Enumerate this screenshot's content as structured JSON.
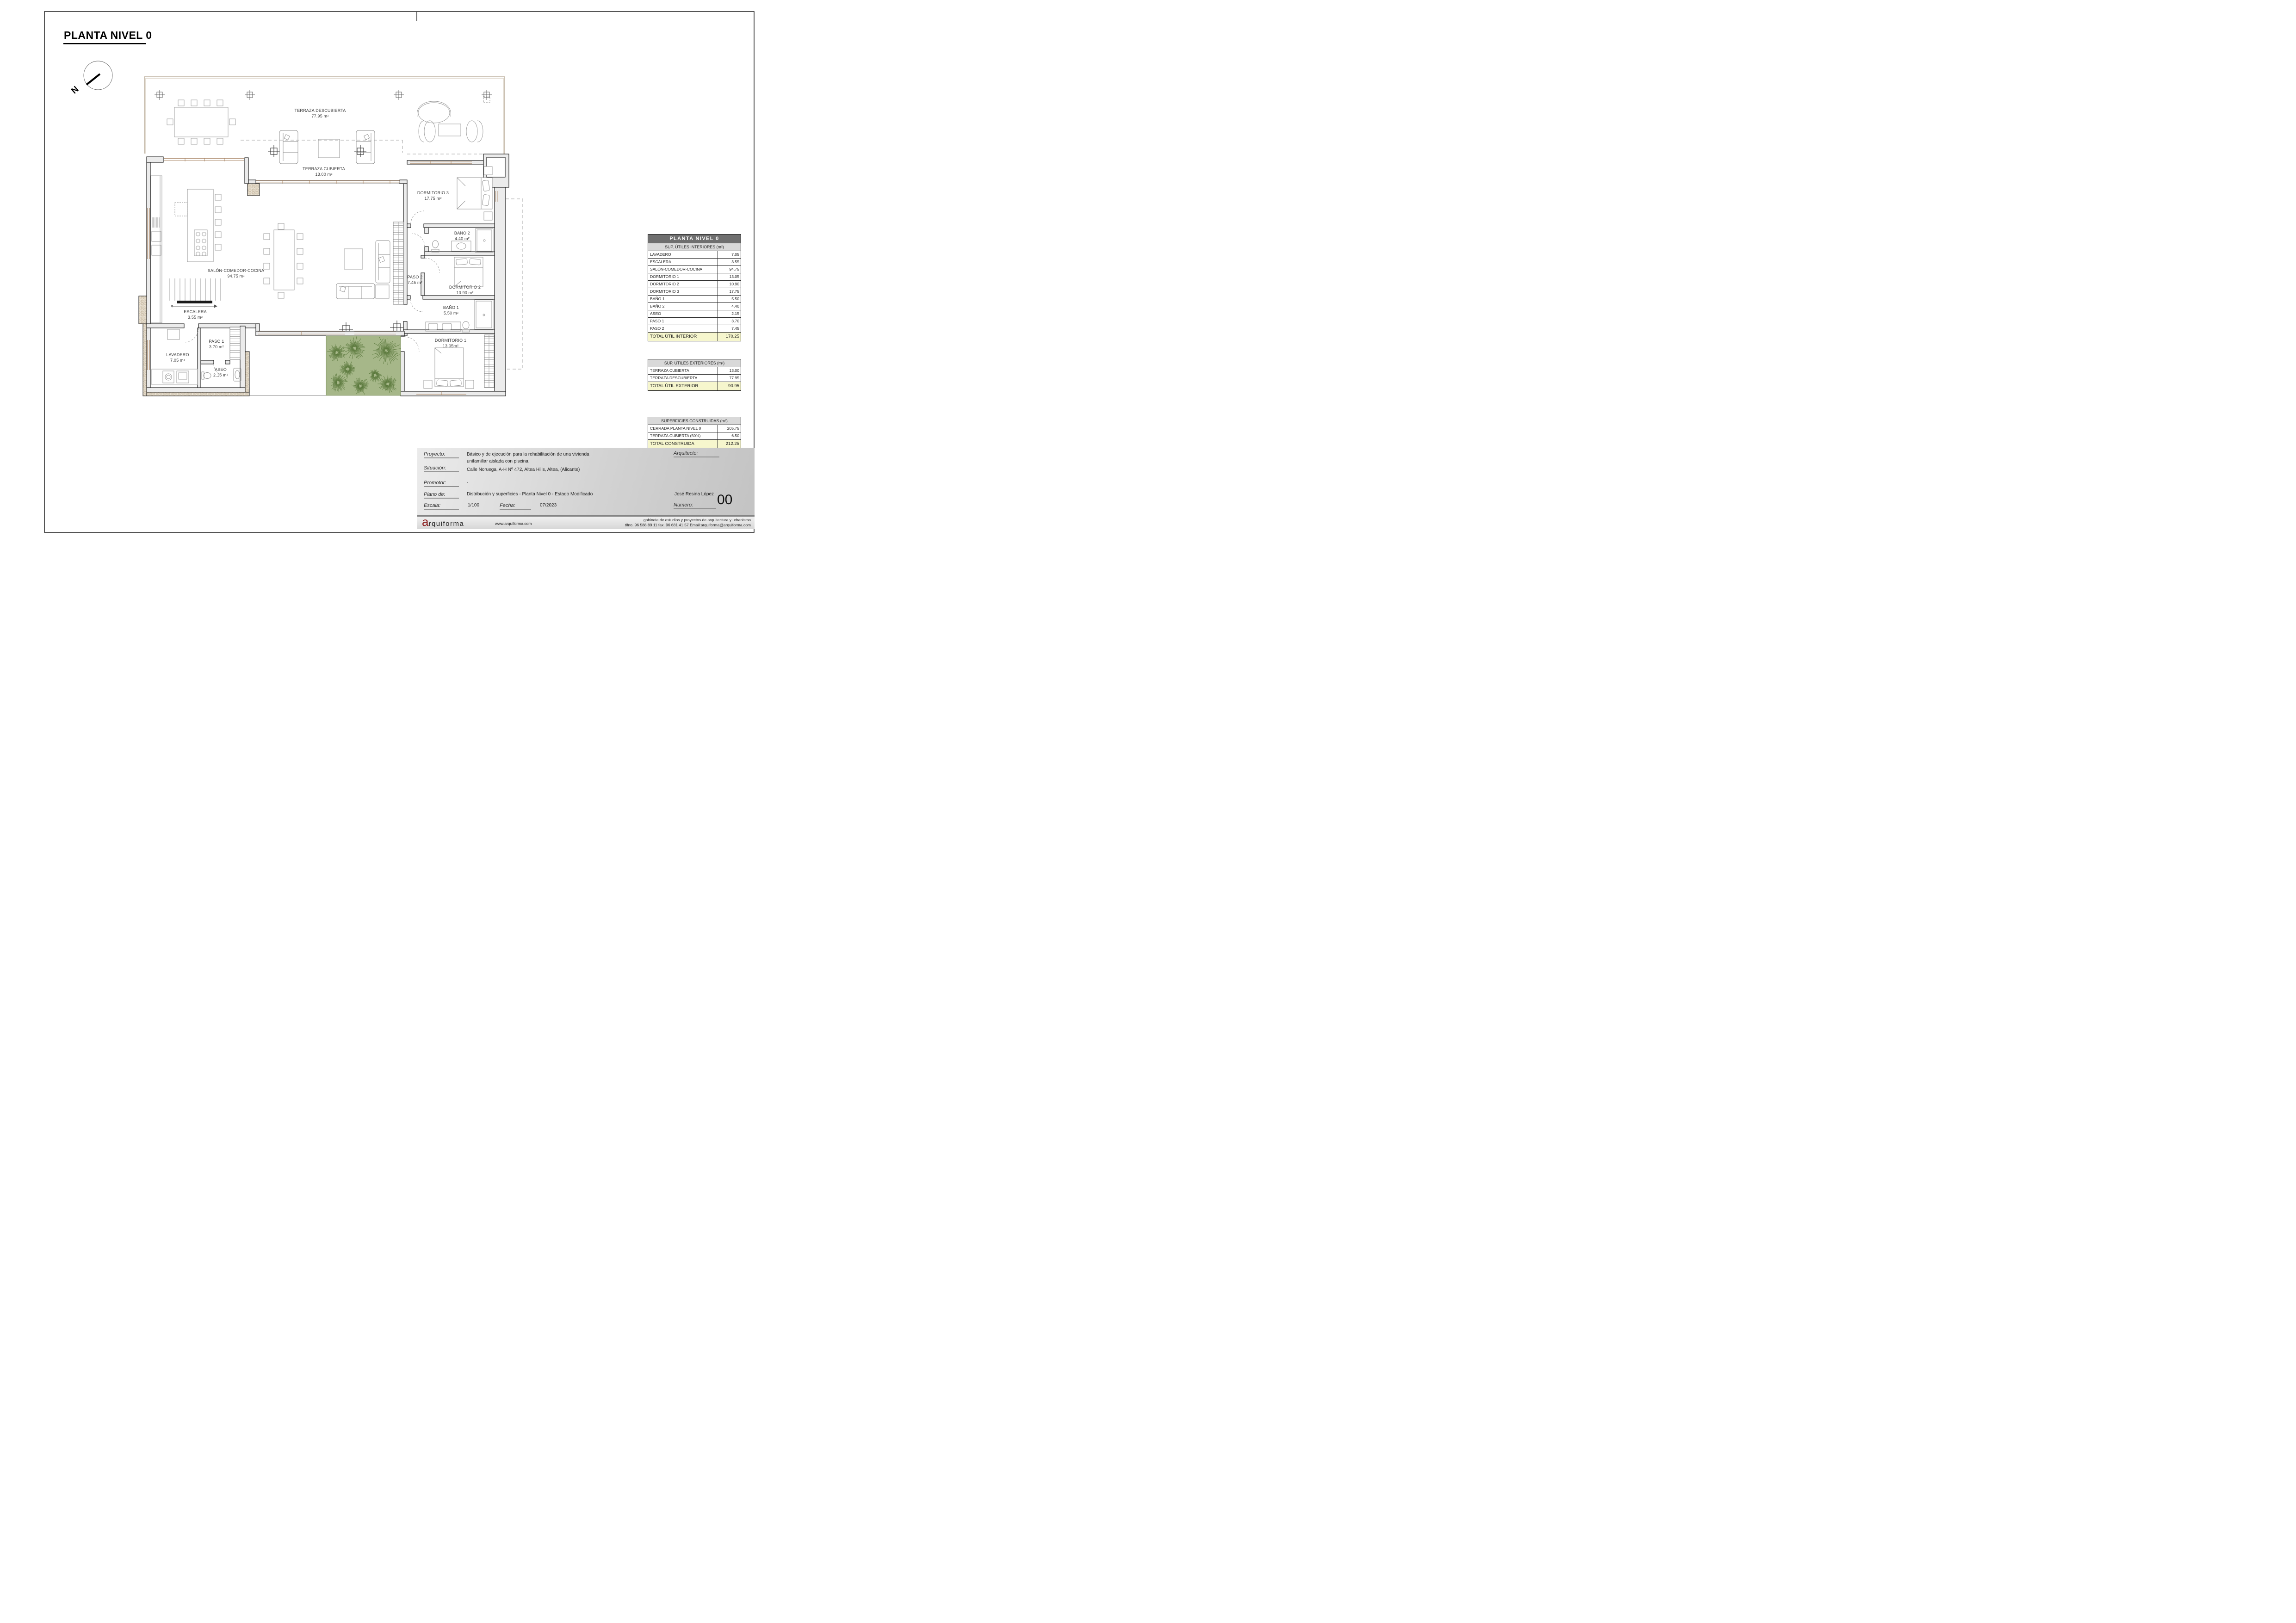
{
  "sheet": {
    "title": "PLANTA NIVEL 0",
    "north_label": "N"
  },
  "plan": {
    "rooms": [
      {
        "name": "TERRAZA DESCUBIERTA",
        "area": "77.95 m²"
      },
      {
        "name": "TERRAZA CUBIERTA",
        "area": "13.00 m²"
      },
      {
        "name": "SALÓN-COMEDOR-COCINA",
        "area": "94.75 m²"
      },
      {
        "name": "DORMITORIO 3",
        "area": "17.75 m²"
      },
      {
        "name": "BAÑO 2",
        "area": "4.40 m²"
      },
      {
        "name": "PASO 2",
        "area": "7.45 m²"
      },
      {
        "name": "DORMITORIO 2",
        "area": "10.90 m²"
      },
      {
        "name": "BAÑO 1",
        "area": "5.50 m²"
      },
      {
        "name": "DORMITORIO 1",
        "area": "13.05m²"
      },
      {
        "name": "ESCALERA",
        "area": "3.55 m²"
      },
      {
        "name": "PASO 1",
        "area": "3.70 m²"
      },
      {
        "name": "LAVADERO",
        "area": "7.05 m²"
      },
      {
        "name": "ASEO",
        "area": "2.15 m²"
      }
    ]
  },
  "tables": {
    "interior": {
      "header": "PLANTA NIVEL 0",
      "subheader": "SUP. ÚTILES INTERIORES (m²)",
      "rows": [
        {
          "label": "LAVADERO",
          "value": "7.05"
        },
        {
          "label": "ESCALERA",
          "value": "3.55"
        },
        {
          "label": "SALÓN-COMEDOR-COCINA",
          "value": "94.75"
        },
        {
          "label": "DORMITORIO 1",
          "value": "13.05"
        },
        {
          "label": "DORMITORIO 2",
          "value": "10.90"
        },
        {
          "label": "DORMITORIO 3",
          "value": "17.75"
        },
        {
          "label": "BAÑO 1",
          "value": "5.50"
        },
        {
          "label": "BAÑO 2",
          "value": "4.40"
        },
        {
          "label": "ASEO",
          "value": "2.15"
        },
        {
          "label": "PASO 1",
          "value": "3.70"
        },
        {
          "label": "PASO 2",
          "value": "7.45"
        }
      ],
      "total_label": "TOTAL ÚTIL INTERIOR",
      "total_value": "170.25"
    },
    "exterior": {
      "subheader": "SUP. ÚTILES EXTERIORES (m²)",
      "rows": [
        {
          "label": "TERRAZA CUBIERTA",
          "value": "13.00"
        },
        {
          "label": "TERRAZA DESCUBIERTA",
          "value": "77.95"
        }
      ],
      "total_label": "TOTAL ÚTIL EXTERIOR",
      "total_value": "90.95"
    },
    "construidas": {
      "subheader": "SUPERFICIES CONSTRUIDAS (m²)",
      "rows": [
        {
          "label": "CERRADA PLANTA NIVEL 0",
          "value": "205.75"
        },
        {
          "label": "TERRAZA CUBIERTA (50%)",
          "value": "6.50"
        }
      ],
      "total_label": "TOTAL CONSTRUIDA",
      "total_value": "212.25"
    }
  },
  "titleblock": {
    "proyecto_label": "Proyecto:",
    "proyecto_line1": "Básico y de ejecución para la rehabilitación de una vivienda",
    "proyecto_line2": "unifamiliar aislada con piscina.",
    "situacion_label": "Situación:",
    "situacion_value": "Calle Noruega, A-H  Nº 472, Altea Hills, Altea, (Alicante)",
    "promotor_label": "Promotor:",
    "promotor_value": "-",
    "plano_label": "Plano de:",
    "plano_value": "Distribución y superficies - Planta Nivel 0 - Estado Modificado",
    "escala_label": "Escala:",
    "escala_value": "1/100",
    "fecha_label": "Fecha:",
    "fecha_value": "07/2023",
    "arquitecto_label": "Arquitecto:",
    "arquitecto_name": "José Resina López",
    "numero_label": "Número:",
    "numero_value": "00"
  },
  "footer": {
    "logo_a": "a",
    "logo_rest": "rquiforma",
    "web": "www.arquiforma.com",
    "tagline": "gabinete de estudios y proyectos de arquitectura y urbanismo",
    "contact": "tlfno. 96 588 89 11  fax. 96 681 41 57  Email:arquiforma@arquiforma.com"
  },
  "colors": {
    "accent_red": "#8b1d1d",
    "garden_green": "#a6b789",
    "tree_green": "#567538",
    "wall_grey": "#ececec",
    "window_brown": "#a5815f",
    "table_header_grey": "#6f6f6f",
    "total_yellow": "#f6f6cd"
  }
}
